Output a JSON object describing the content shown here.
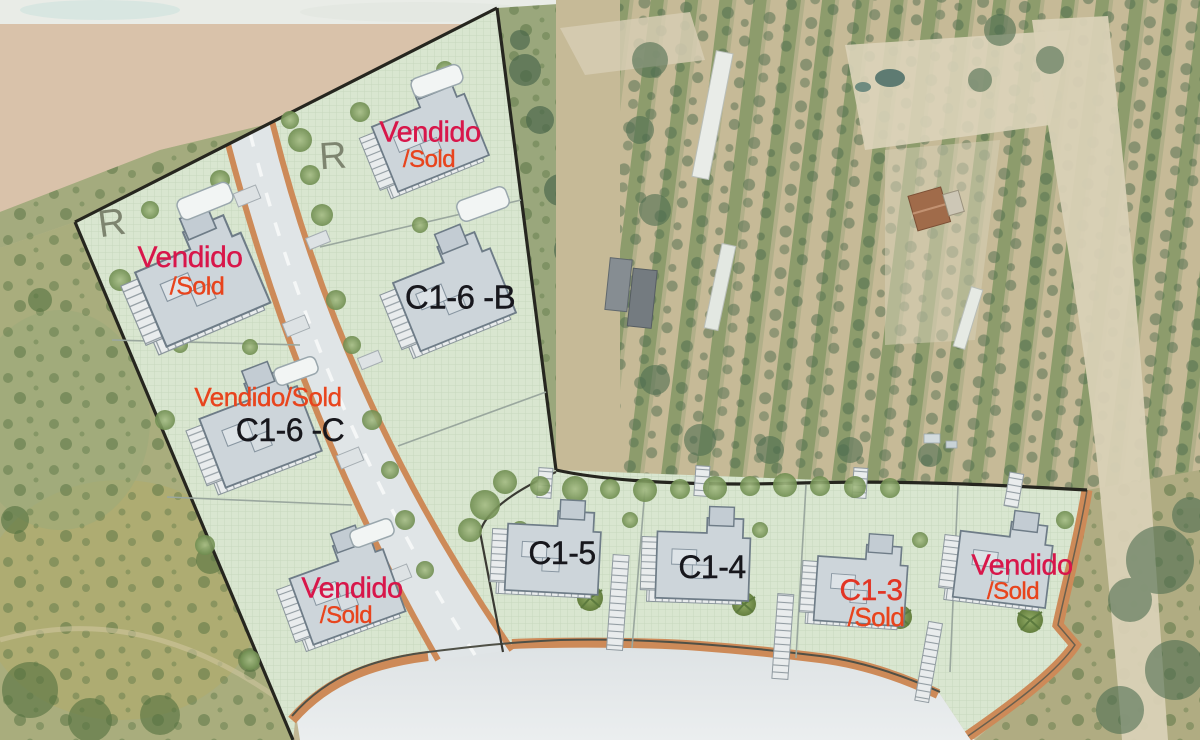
{
  "map": {
    "type": "development-site-plan-over-aerial-photo",
    "plots": [
      {
        "id": "top-left",
        "status": "Vendido",
        "status2": "/Sold"
      },
      {
        "id": "top",
        "status": "Vendido",
        "status2": "/Sold"
      },
      {
        "id": "c16b",
        "code": "C1-6 -B"
      },
      {
        "id": "c16c",
        "status": "Vendido/Sold",
        "code": "C1-6 -C"
      },
      {
        "id": "bottom-left",
        "status": "Vendido",
        "status2": "/Sold"
      },
      {
        "id": "c15",
        "code": "C1-5"
      },
      {
        "id": "c14",
        "code": "C1-4"
      },
      {
        "id": "c13",
        "code": "C1-3",
        "status2": "/Sold"
      },
      {
        "id": "right",
        "status": "Vendido",
        "status2": "/Sold"
      }
    ],
    "handwritten_marks": {
      "r1": "R",
      "r2": "R"
    },
    "colors": {
      "sold_crimson": "#d8164a",
      "sold_orange": "#e8441d",
      "code_red": "#e23524",
      "code_black": "#17171c",
      "plan_green": "#d9e6d0",
      "road_gray": "#e0e5e7",
      "curb_orange": "#cd8a58",
      "boundary_black": "#26261f"
    }
  }
}
